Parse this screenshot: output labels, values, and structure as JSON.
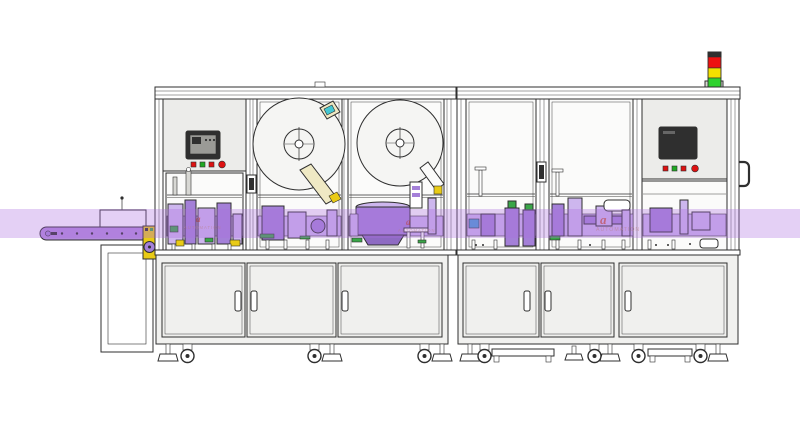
{
  "scene": {
    "watermark": {
      "logo_char": "a",
      "brand_text": "AUTOMATION"
    }
  },
  "icons": {
    "signal_tower_lights": [
      "red",
      "yellow",
      "green"
    ],
    "hmi_buttons_left": [
      "red",
      "green",
      "red",
      "red-round"
    ],
    "hmi_buttons_right": [
      "red",
      "green",
      "red",
      "red-round"
    ]
  },
  "colors": {
    "frame_line": "#2f2f2f",
    "machine_body": "#f1f1ef",
    "window": "#fbfbfa",
    "panel": "#ececea",
    "cabinet_door": "#f0f0ee",
    "reel_fill": "#f5f5f3",
    "screen_light": "#9a9a96",
    "belt_purple": "#b48bdd",
    "mech_purple": "#a480d8",
    "mech_purple_light": "#cdb6ee",
    "mech_purple_dark": "#8e6bc2",
    "mech_green": "#3aa648",
    "motor_yellow": "#e9cb16",
    "btn_red": "#dd1111",
    "btn_green": "#1fa822",
    "tower_red": "#ee1111",
    "tower_yellow": "#f2e000",
    "tower_green": "#2ed22e",
    "band": "rgba(170,110,225,0.32)",
    "wm_logo": "#c0392b",
    "wm_text": "#b97a7a"
  }
}
